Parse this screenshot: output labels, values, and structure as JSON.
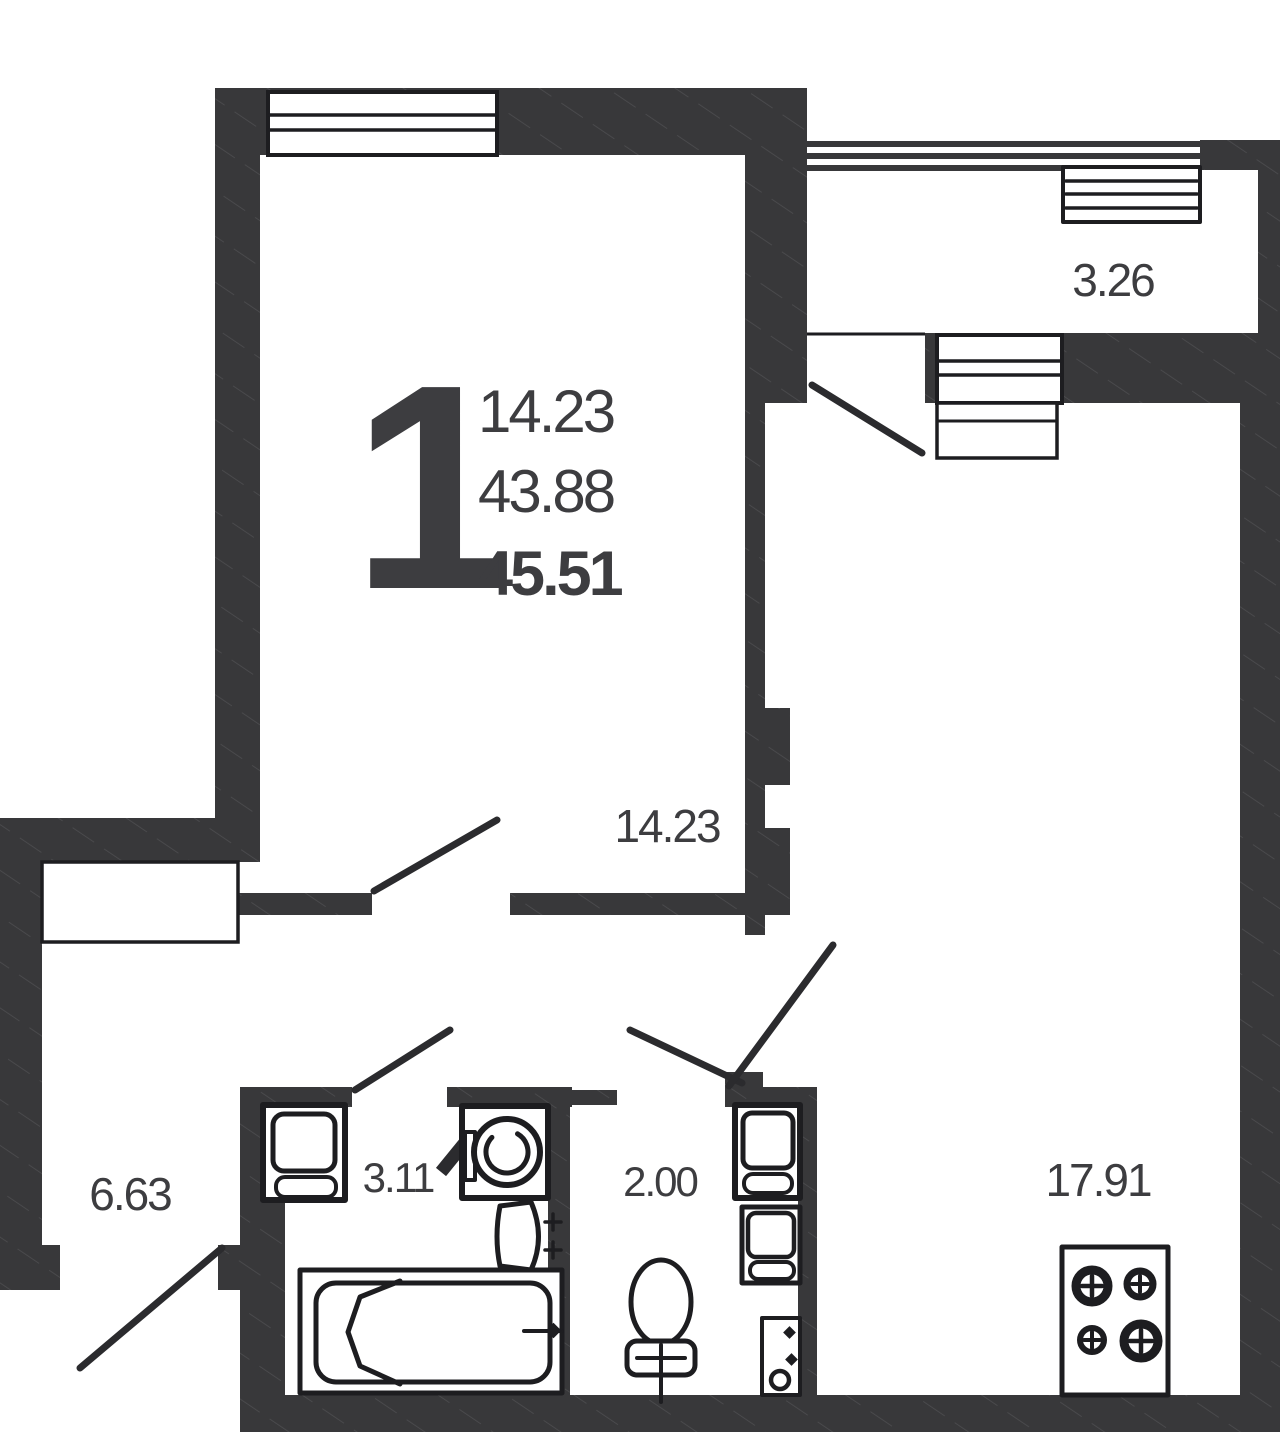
{
  "unit": {
    "rooms_count": "1",
    "living_area": "14.23",
    "area_without_balcony": "43.88",
    "total_area": "45.51"
  },
  "rooms": {
    "balcony": {
      "area": "3.26"
    },
    "living_room": {
      "area": "14.23"
    },
    "hallway": {
      "area": "6.63"
    },
    "bathroom": {
      "area": "3.11"
    },
    "wc": {
      "area": "2.00"
    },
    "kitchen_living": {
      "area": "17.91"
    }
  },
  "colors": {
    "wall": "#38383a",
    "line": "#1d1d20",
    "text": "#3d3d40",
    "swing": "#2b2b2e",
    "bg": "#ffffff"
  }
}
